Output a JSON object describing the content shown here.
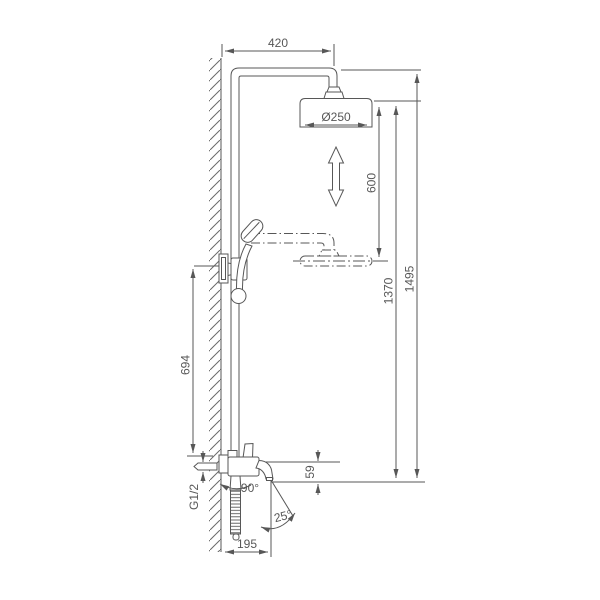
{
  "drawing": {
    "dimensions": {
      "top_offset_width": "420",
      "shower_head_diameter": "Ø250",
      "height_adjustment_range": "600",
      "spout_to_head_height": "1370",
      "total_height": "1495",
      "inlet_to_holder_height": "694",
      "spout_drop": "59",
      "inlet_thread": "G1/2",
      "spout_swivel_angle": "90°",
      "spout_flow_angle": "25°",
      "spout_reach": "195"
    },
    "colors": {
      "line": "#575757",
      "background": "#ffffff"
    }
  }
}
